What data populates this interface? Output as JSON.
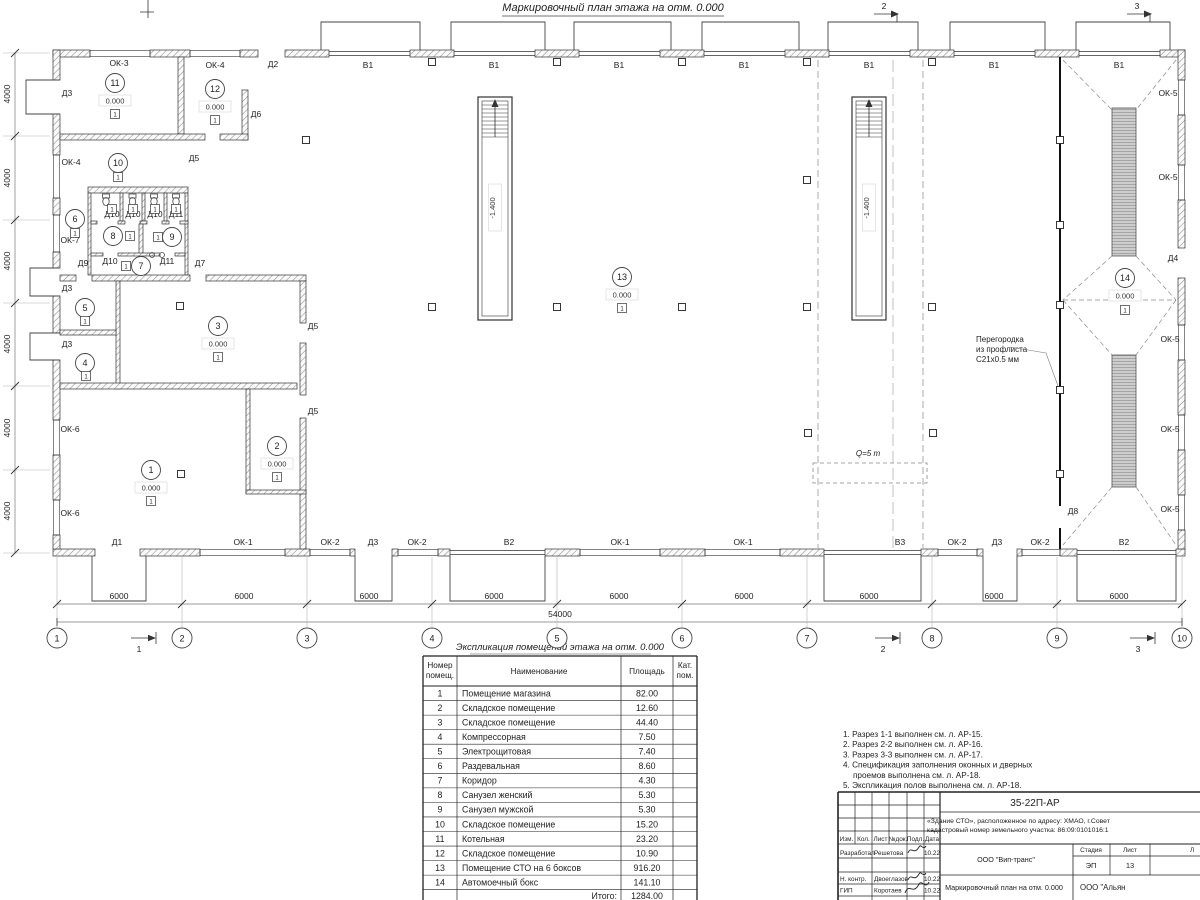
{
  "page_title": "Маркировочный план этажа на отм. 0.000",
  "plan": {
    "elevation": "0.000",
    "pit_level": "-1.400",
    "floor_type": "1",
    "crane_label": "Q=5 т",
    "annotation": {
      "l1": "Перегородка",
      "l2": "из профлиста",
      "l3": "С21х0.5 мм"
    },
    "opening_labels": [
      {
        "t": "Д2",
        "x": 273,
        "y": 67
      },
      {
        "t": "В1",
        "x": 368,
        "y": 68
      },
      {
        "t": "В1",
        "x": 494,
        "y": 68
      },
      {
        "t": "В1",
        "x": 619,
        "y": 68
      },
      {
        "t": "В1",
        "x": 744,
        "y": 68
      },
      {
        "t": "В1",
        "x": 869,
        "y": 68
      },
      {
        "t": "В1",
        "x": 994,
        "y": 68
      },
      {
        "t": "В1",
        "x": 1119,
        "y": 68
      },
      {
        "t": "ОК-3",
        "x": 119,
        "y": 66
      },
      {
        "t": "ОК-4",
        "x": 215,
        "y": 68
      },
      {
        "t": "Д3",
        "x": 67,
        "y": 96
      },
      {
        "t": "Д6",
        "x": 256,
        "y": 117
      },
      {
        "t": "Д5",
        "x": 194,
        "y": 161
      },
      {
        "t": "ОК-4",
        "x": 71,
        "y": 165
      },
      {
        "t": "ОК-7",
        "x": 70,
        "y": 243
      },
      {
        "t": "Д10",
        "x": 112,
        "y": 217
      },
      {
        "t": "Д10",
        "x": 133,
        "y": 217
      },
      {
        "t": "Д10",
        "x": 155,
        "y": 217
      },
      {
        "t": "Д11",
        "x": 176,
        "y": 217
      },
      {
        "t": "Д9",
        "x": 83,
        "y": 266
      },
      {
        "t": "Д10",
        "x": 110,
        "y": 264
      },
      {
        "t": "Д11",
        "x": 167,
        "y": 264
      },
      {
        "t": "Д7",
        "x": 200,
        "y": 266
      },
      {
        "t": "Д3",
        "x": 67,
        "y": 291
      },
      {
        "t": "Д3",
        "x": 67,
        "y": 347
      },
      {
        "t": "Д5",
        "x": 313,
        "y": 329
      },
      {
        "t": "Д5",
        "x": 313,
        "y": 414
      },
      {
        "t": "ОК-6",
        "x": 70,
        "y": 432
      },
      {
        "t": "ОК-6",
        "x": 70,
        "y": 516
      },
      {
        "t": "Д1",
        "x": 117,
        "y": 545
      },
      {
        "t": "ОК-1",
        "x": 243,
        "y": 545
      },
      {
        "t": "ОК-2",
        "x": 330,
        "y": 545
      },
      {
        "t": "Д3",
        "x": 373,
        "y": 545
      },
      {
        "t": "ОК-2",
        "x": 417,
        "y": 545
      },
      {
        "t": "В2",
        "x": 509,
        "y": 545
      },
      {
        "t": "ОК-1",
        "x": 620,
        "y": 545
      },
      {
        "t": "ОК-1",
        "x": 743,
        "y": 545
      },
      {
        "t": "В3",
        "x": 900,
        "y": 545
      },
      {
        "t": "ОК-2",
        "x": 957,
        "y": 545
      },
      {
        "t": "Д3",
        "x": 997,
        "y": 545
      },
      {
        "t": "ОК-2",
        "x": 1040,
        "y": 545
      },
      {
        "t": "В2",
        "x": 1124,
        "y": 545
      },
      {
        "t": "Д8",
        "x": 1073,
        "y": 514
      },
      {
        "t": "Д4",
        "x": 1173,
        "y": 261
      },
      {
        "t": "ОК-5",
        "x": 1168,
        "y": 96
      },
      {
        "t": "ОК-5",
        "x": 1168,
        "y": 180
      },
      {
        "t": "ОК-5",
        "x": 1170,
        "y": 342
      },
      {
        "t": "ОК-5",
        "x": 1170,
        "y": 432
      },
      {
        "t": "ОК-5",
        "x": 1170,
        "y": 512
      }
    ],
    "room_markers": [
      {
        "n": "11",
        "x": 115,
        "y": 83,
        "e": true
      },
      {
        "n": "12",
        "x": 215,
        "y": 89,
        "e": true
      },
      {
        "n": "10",
        "x": 118,
        "y": 163
      },
      {
        "n": "6",
        "x": 75,
        "y": 219
      },
      {
        "n": "8",
        "x": 113,
        "y": 236
      },
      {
        "n": "9",
        "x": 172,
        "y": 237
      },
      {
        "n": "7",
        "x": 141,
        "y": 266
      },
      {
        "n": "5",
        "x": 85,
        "y": 308
      },
      {
        "n": "4",
        "x": 85,
        "y": 363
      },
      {
        "n": "3",
        "x": 218,
        "y": 326,
        "e": true
      },
      {
        "n": "1",
        "x": 151,
        "y": 470,
        "e": true
      },
      {
        "n": "2",
        "x": 277,
        "y": 446,
        "e": true
      },
      {
        "n": "13",
        "x": 622,
        "y": 277,
        "e": true
      },
      {
        "n": "14",
        "x": 1125,
        "y": 278,
        "e": true
      }
    ],
    "floor_squares": [
      [
        115,
        114
      ],
      [
        215,
        120
      ],
      [
        118,
        177
      ],
      [
        75,
        233
      ],
      [
        130,
        236
      ],
      [
        158,
        237
      ],
      [
        126,
        266
      ],
      [
        85,
        321
      ],
      [
        86,
        376
      ],
      [
        218,
        357
      ],
      [
        151,
        501
      ],
      [
        277,
        477
      ],
      [
        622,
        308
      ],
      [
        1125,
        310
      ],
      [
        112,
        209
      ],
      [
        133,
        209
      ],
      [
        155,
        209
      ],
      [
        176,
        209
      ]
    ],
    "columns": [
      [
        306,
        140
      ],
      [
        180,
        306
      ],
      [
        432,
        307
      ],
      [
        557,
        307
      ],
      [
        682,
        307
      ],
      [
        807,
        307
      ],
      [
        932,
        307
      ],
      [
        807,
        180
      ],
      [
        808,
        433
      ],
      [
        933,
        433
      ],
      [
        181,
        474
      ],
      [
        1060,
        140
      ],
      [
        1060,
        225
      ],
      [
        1060,
        305
      ],
      [
        1060,
        390
      ],
      [
        1060,
        474
      ],
      [
        432,
        62
      ],
      [
        557,
        62
      ],
      [
        682,
        62
      ],
      [
        807,
        62
      ],
      [
        932,
        62
      ]
    ]
  },
  "grid": {
    "bubbles": [
      {
        "n": "1",
        "x": 57
      },
      {
        "n": "2",
        "x": 182
      },
      {
        "n": "3",
        "x": 307
      },
      {
        "n": "4",
        "x": 432
      },
      {
        "n": "5",
        "x": 557
      },
      {
        "n": "6",
        "x": 682
      },
      {
        "n": "7",
        "x": 807
      },
      {
        "n": "8",
        "x": 932
      },
      {
        "n": "9",
        "x": 1057
      },
      {
        "n": "10",
        "x": 1182
      }
    ],
    "dim_bottom": [
      {
        "t": "6000",
        "x": 119
      },
      {
        "t": "6000",
        "x": 244
      },
      {
        "t": "6000",
        "x": 369
      },
      {
        "t": "6000",
        "x": 494
      },
      {
        "t": "6000",
        "x": 619
      },
      {
        "t": "6000",
        "x": 744
      },
      {
        "t": "6000",
        "x": 869
      },
      {
        "t": "6000",
        "x": 994
      },
      {
        "t": "6000",
        "x": 1119
      }
    ],
    "dim_total": {
      "t": "54000",
      "x": 560
    },
    "dim_left": [
      {
        "t": "4000",
        "y": 94
      },
      {
        "t": "4000",
        "y": 178
      },
      {
        "t": "4000",
        "y": 261
      },
      {
        "t": "4000",
        "y": 344
      },
      {
        "t": "4000",
        "y": 428
      },
      {
        "t": "4000",
        "y": 511
      }
    ],
    "marks_top": [
      {
        "n": "2",
        "x": 884
      },
      {
        "n": "3",
        "x": 1137
      }
    ],
    "marks_bottom": [
      {
        "n": "1",
        "x": 139
      },
      {
        "n": "2",
        "x": 883
      },
      {
        "n": "3",
        "x": 1138
      }
    ]
  },
  "explication": {
    "title": "Экспликация помещений этажа на отм. 0.000",
    "h": {
      "num1": "Номер",
      "num2": "помещ.",
      "name": "Наименование",
      "area": "Площадь",
      "cat1": "Кат.",
      "cat2": "пом."
    },
    "rows": [
      [
        "1",
        "Помещение магазина",
        "82.00"
      ],
      [
        "2",
        "Складское помещение",
        "12.60"
      ],
      [
        "3",
        "Складское помещение",
        "44.40"
      ],
      [
        "4",
        "Компрессорная",
        "7.50"
      ],
      [
        "5",
        "Электрощитовая",
        "7.40"
      ],
      [
        "6",
        "Раздевальная",
        "8.60"
      ],
      [
        "7",
        "Коридор",
        "4.30"
      ],
      [
        "8",
        "Санузел женский",
        "5.30"
      ],
      [
        "9",
        "Санузел мужской",
        "5.30"
      ],
      [
        "10",
        "Складское помещение",
        "15.20"
      ],
      [
        "11",
        "Котельная",
        "23.20"
      ],
      [
        "12",
        "Складское помещение",
        "10.90"
      ],
      [
        "13",
        "Помещение СТО на 6 боксов",
        "916.20"
      ],
      [
        "14",
        "Автомоечный бокс",
        "141.10"
      ]
    ],
    "total_label": "Итого:",
    "total_value": "1284.00"
  },
  "notes": [
    "1. Разрез 1-1 выполнен см. л. АР-15.",
    "2. Разрез 2-2 выполнен см. л. АР-16.",
    "3. Разрез 3-3 выполнен см. л. АР-17.",
    "4. Спецификация заполнения оконных и дверных",
    "проемов выполнена см. л. АР-18.",
    "5. Экспликация полов выполнена см. л. АР-18."
  ],
  "titleblock": {
    "doc_code": "35-22П-АР",
    "project_line1": "«Здание СТО», расположенное по адресу: ХМАО, г.Совет",
    "project_line2": "кадастровый номер земельного участка: 86:09:0101016:1",
    "header_cols": [
      "Изм.",
      "Кол.",
      "Лист",
      "№док.",
      "Подл.",
      "Дата"
    ],
    "sign_rows": [
      {
        "role": "Разработал",
        "name": "Решетова",
        "date": "10.22"
      },
      {
        "role": "Н. контр.",
        "name": "Двоеглазов",
        "date": "10.22"
      },
      {
        "role": "ГИП",
        "name": "Коротаев",
        "date": "10.22"
      }
    ],
    "org1": "ООО \"Вип-транс\"",
    "stage_label": "Стадия",
    "stage_value": "ЭП",
    "sheet_label": "Лист",
    "sheet_value": "13",
    "sheets_label": "Л",
    "drawing_title": "Маркировочный план на отм. 0.000",
    "org2": "ООО \"Альян"
  }
}
